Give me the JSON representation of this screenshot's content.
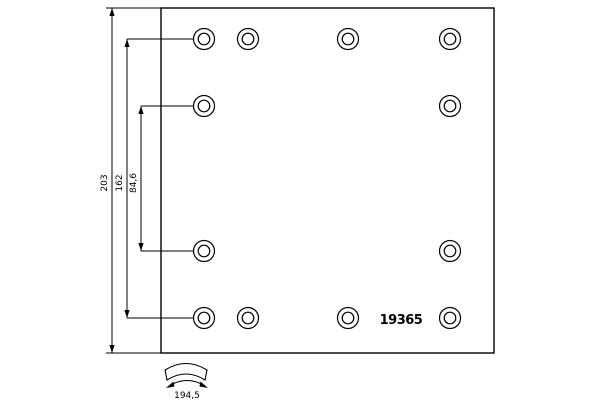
{
  "drawing": {
    "part_number": "19365",
    "dimensions": {
      "overall_height": "203",
      "rivet_span_outer": "162",
      "rivet_span_inner": "84,6",
      "lining_arc_width": "194,5"
    },
    "rivet_holes": {
      "columns_x": [
        204,
        248,
        348,
        450
      ],
      "rows_y": [
        39,
        106,
        251,
        318
      ],
      "pattern": [
        [
          1,
          1,
          1,
          1
        ],
        [
          1,
          0,
          0,
          1
        ],
        [
          1,
          0,
          0,
          1
        ],
        [
          1,
          1,
          1,
          1
        ]
      ],
      "outer_radius": 10.5,
      "inner_radius": 5.8
    }
  },
  "colors": {
    "line": "#000000",
    "background": "#ffffff"
  }
}
